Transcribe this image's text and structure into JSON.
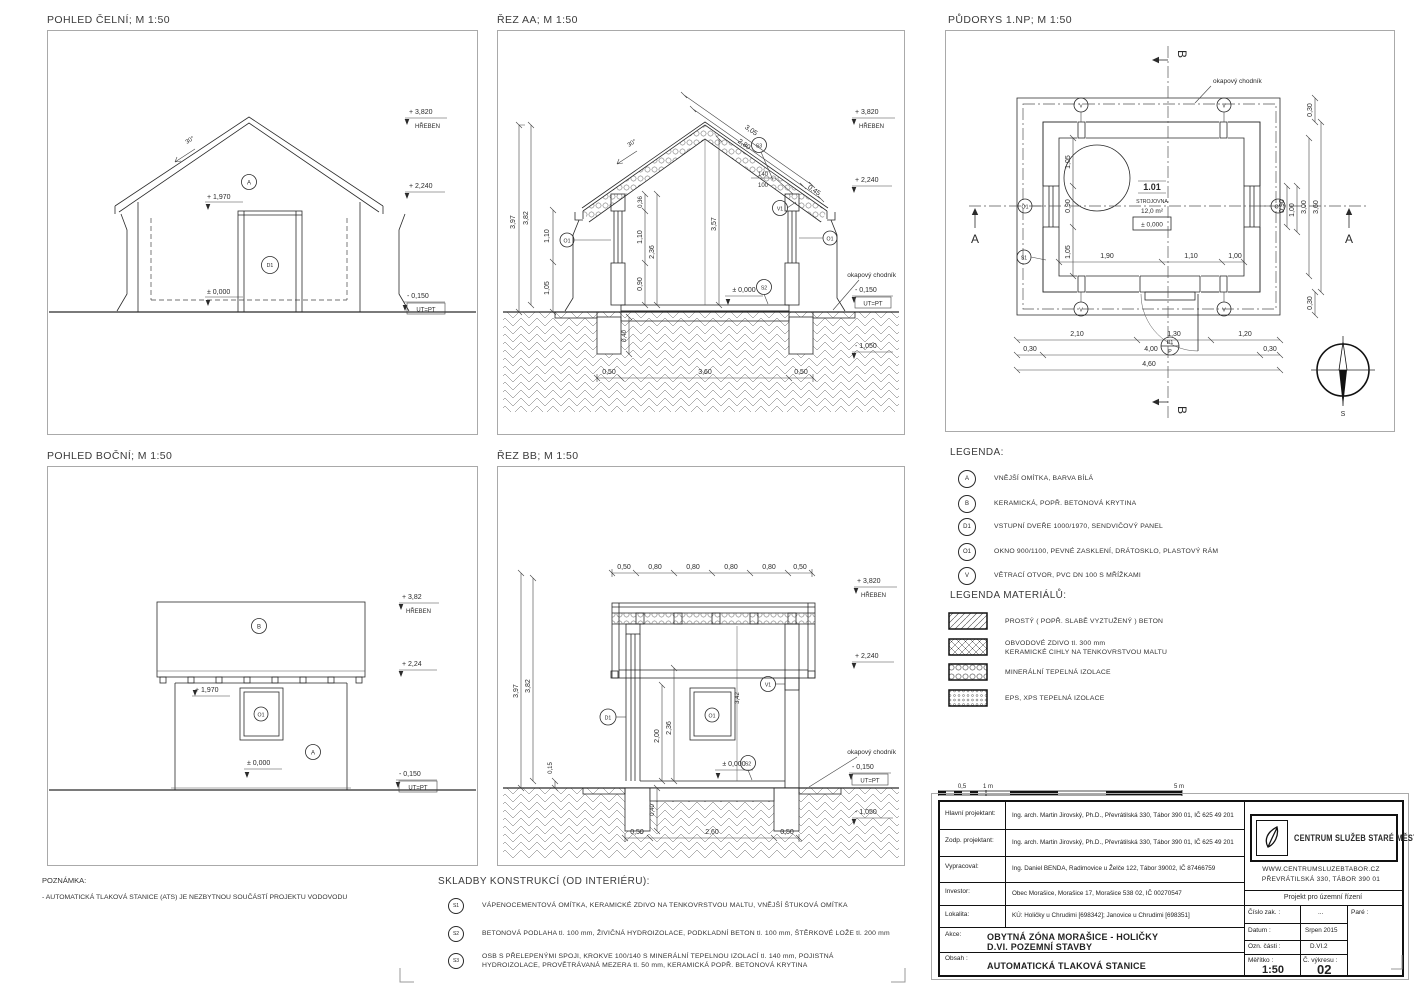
{
  "p1": {
    "title": "POHLED ČELNÍ; M 1:50",
    "lv_ridge": "+ 3,820",
    "ridge_name": "HŘEBEN",
    "lv_eave": "+ 2,240",
    "lv_door": "+ 1,970",
    "lv_zero": "± 0,000",
    "lv_ground": "- 0,150",
    "ut": "UT=PT",
    "slope": "30°",
    "mk_a": "A",
    "mk_d1": "D1"
  },
  "p2": {
    "title": "ŘEZ AA; M 1:50",
    "lv_ridge": "+ 3,820",
    "ridge_name": "HŘEBEN",
    "lv_eave": "+ 2,240",
    "lv_zero": "± 0,000",
    "lv_ground": "- 0,150",
    "ut": "UT=PT",
    "lv_found": "- 1,050",
    "chodnik": "okapový chodník",
    "slope": "30°",
    "mk_s3": "S3",
    "mk_v1": "V1",
    "mk_o1": "O1",
    "mk_s2": "S2",
    "d397": "3,97",
    "d382": "3,82",
    "d110": "1,10",
    "d105": "1,05",
    "d036": "0,36",
    "d236": "2,36",
    "d090": "0,90",
    "d357": "3,57",
    "d305": "3,05",
    "d280": "2,80",
    "d045": "0,45",
    "f140": "140",
    "f100": "100",
    "d050": "0,50",
    "d360": "3,60",
    "d040": "0,40"
  },
  "plan": {
    "title": "PŮDORYS 1.NP; M 1:50",
    "room_no": "1.01",
    "room_name": "STROJOVNA",
    "room_area": "12,0 m²",
    "room_level": "± 0,000",
    "chodnik": "okapový chodník",
    "sec_a": "A",
    "sec_b": "B",
    "mk_v": "V",
    "mk_o1": "O1",
    "mk_s1": "S1",
    "mk_d1": "D1",
    "mk_p": "P",
    "compass": "S",
    "d105": "1,05",
    "d090": "0,90",
    "d190": "1,90",
    "d110": "1,10",
    "d100": "1,00",
    "d210": "2,10",
    "d130": "1,30",
    "d120": "1,20",
    "d030": "0,30",
    "d400": "4,00",
    "d460": "4,60",
    "d300": "3,00",
    "d360": "3,60"
  },
  "p4": {
    "title": "POHLED BOČNÍ; M 1:50",
    "lv_ridge": "+ 3,82",
    "ridge_name": "HŘEBEN",
    "lv_eave": "+ 2,24",
    "lv_door": "+ 1,970",
    "lv_zero": "± 0,000",
    "lv_ground": "- 0,150",
    "ut": "UT=PT",
    "mk_b": "B",
    "mk_o1": "O1",
    "mk_a": "A"
  },
  "p5": {
    "title": "ŘEZ BB; M 1:50",
    "lv_ridge": "+ 3,820",
    "ridge_name": "HŘEBEN",
    "lv_eave": "+ 2,240",
    "lv_zero": "± 0,000",
    "lv_ground": "- 0,150",
    "ut": "UT=PT",
    "lv_found": "- 1,050",
    "chodnik": "okapový chodník",
    "mk_d1": "D1",
    "mk_o1": "O1",
    "mk_v1": "V1",
    "mk_s2": "S2",
    "t050": "0,50",
    "t080": "0,80",
    "d397": "3,97",
    "d382": "3,82",
    "d015": "0,15",
    "d200": "2,00",
    "d236": "2,36",
    "d342": "3,42",
    "b050": "0,50",
    "b260": "2,60",
    "d040": "0,40"
  },
  "legend": {
    "title": "LEGENDA:",
    "items": [
      {
        "k": "A",
        "t": "VNĚJŠÍ OMÍTKA, BARVA BÍLÁ"
      },
      {
        "k": "B",
        "t": "KERAMICKÁ, POPŘ. BETONOVÁ KRYTINA"
      },
      {
        "k": "D1",
        "t": "VSTUPNÍ DVEŘE 1000/1970, SENDVIČOVÝ PANEL"
      },
      {
        "k": "O1",
        "t": "OKNO 900/1100, PEVNÉ ZASKLENÍ, DRÁTOSKLO, PLASTOVÝ RÁM"
      },
      {
        "k": "V",
        "t": "VĚTRACÍ OTVOR, PVC DN 100 S MŘÍŽKAMI"
      }
    ]
  },
  "materials": {
    "title": "LEGENDA MATERIÁLŮ:",
    "items": [
      {
        "line1": "PROSTÝ ( POPŘ. SLABĚ VYZTUŽENÝ ) BETON",
        "line2": ""
      },
      {
        "line1": "OBVODOVÉ ZDIVO tl. 300 mm",
        "line2": "KERAMICKÉ CIHLY NA TENKOVRSTVOU MALTU"
      },
      {
        "line1": "MINERÁLNÍ TEPELNÁ IZOLACE",
        "line2": ""
      },
      {
        "line1": "EPS, XPS TEPELNÁ IZOLACE",
        "line2": ""
      }
    ]
  },
  "note": {
    "title": "POZNÁMKA:",
    "text": "- AUTOMATICKÁ TLAKOVÁ STANICE (ATS) JE NEZBYTNOU SOUČÁSTÍ PROJEKTU VODOVODU"
  },
  "assemblies": {
    "title": "SKLADBY KONSTRUKCÍ (OD INTERIÉRU):",
    "items": [
      {
        "k": "S1",
        "t": "VÁPENOCEMENTOVÁ OMÍTKA, KERAMICKÉ ZDIVO NA TENKOVRSTVOU MALTU, VNĚJŠÍ ŠTUKOVÁ OMÍTKA",
        "t2": ""
      },
      {
        "k": "S2",
        "t": "BETONOVÁ PODLAHA tl. 100 mm, ŽIVIČNÁ HYDROIZOLACE, PODKLADNÍ BETON tl. 100 mm, ŠTĚRKOVÉ LOŽE tl. 200 mm",
        "t2": ""
      },
      {
        "k": "S3",
        "t": "OSB S PŘELEPENÝMI SPOJI, KROKVE 100/140 S MINERÁLNÍ TEPELNOU IZOLACÍ tl. 140 mm, POJISTNÁ",
        "t2": "HYDROIZOLACE, PROVĚTRÁVANÁ MEZERA tl. 50 mm, KERAMICKÁ POPŘ. BETONOVÁ KRYTINA"
      }
    ]
  },
  "scalebar": {
    "l1": "0,5",
    "l2": "1 m",
    "l3": "5 m"
  },
  "titleblock": {
    "rows": [
      {
        "label": "Hlavní projektant:",
        "value": "Ing. arch. Martin Jirovský, Ph.D., Převrátilská 330, Tábor 390 01, IČ 625 49 201"
      },
      {
        "label": "Zodp. projektant:",
        "value": "Ing. arch. Martin Jirovský, Ph.D., Převrátilská 330, Tábor 390 01, IČ 625 49 201"
      },
      {
        "label": "Vypracoval:",
        "value": "Ing. Daniel BENDA, Radimovice u Želče 122, Tábor 39002, IČ 87466759"
      },
      {
        "label": "Investor:",
        "value": "Obec Morašice, Morašice 17, Morašice 538 02, IČ 00270547"
      },
      {
        "label": "Lokalita:",
        "value": "KÚ: Holičky u Chrudimi [698342]; Janovice u Chrudimi [698351]"
      }
    ],
    "akce_label": "Akce:",
    "akce1": "OBYTNÁ ZÓNA MORAŠICE - HOLIČKY",
    "akce2": "D.VI. POZEMNÍ STAVBY",
    "obsah_label": "Obsah :",
    "obsah": "AUTOMATICKÁ TLAKOVÁ STANICE",
    "logo_name": "CENTRUM SLUŽEB STARÉ MĚSTO",
    "logo_web": "WWW.CENTRUMSLUZEBTABOR.CZ",
    "logo_addr": "PŘEVRÁTILSKÁ 330, TÁBOR 390 01",
    "project_type": "Projekt pro územní řízení",
    "cislo_label": "Číslo zak. :",
    "cislo_value": "...",
    "pare_label": "Paré :",
    "datum_label": "Datum :",
    "datum": "Srpen 2015",
    "ozn_label": "Ozn. části :",
    "ozn": "D.VI.2",
    "meritko_label": "Měřítko :",
    "meritko": "1:50",
    "vykres_label": "Č. výkresu :",
    "vykres": "02"
  }
}
